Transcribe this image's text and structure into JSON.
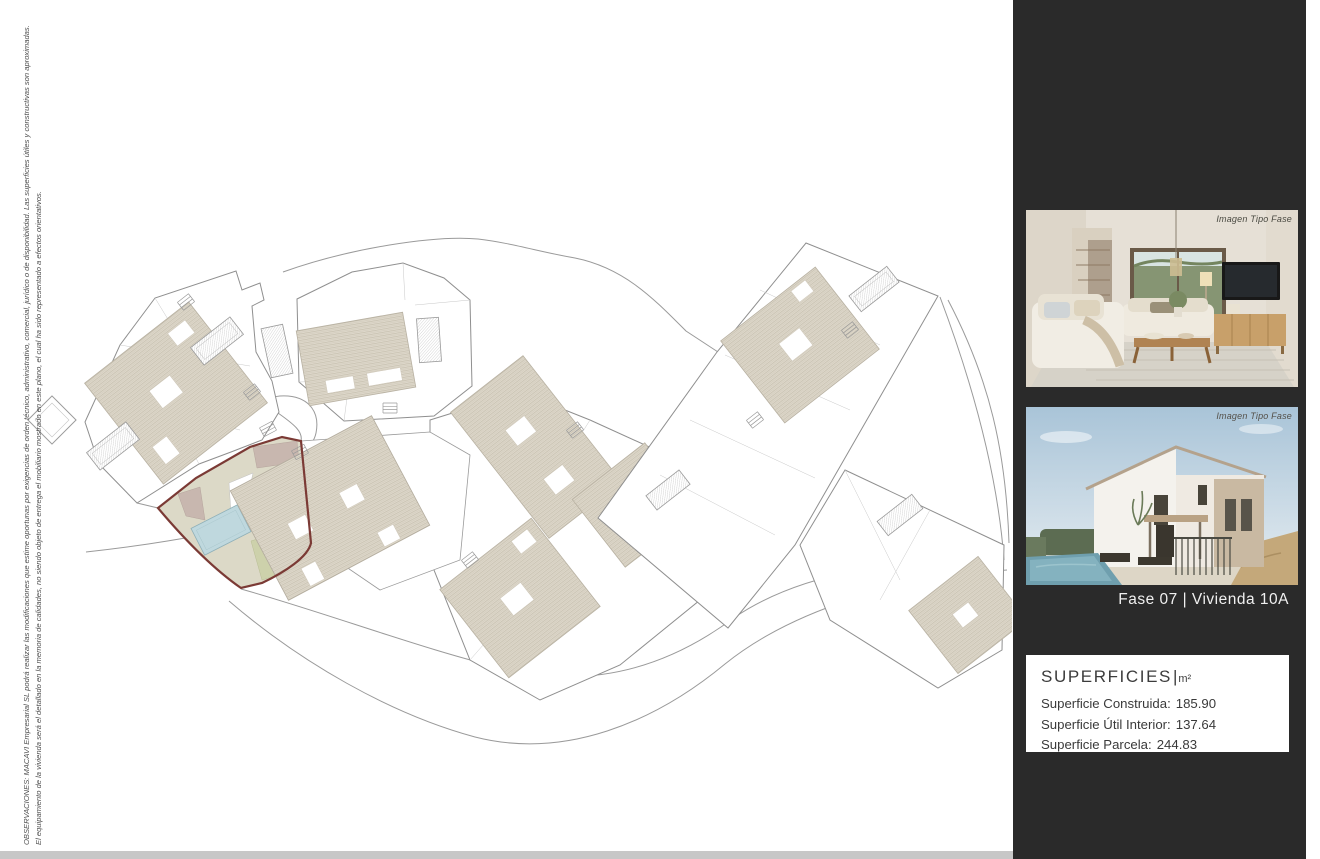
{
  "page": {
    "background": "#ffffff",
    "bottom_bar_color": "#c7c7c7"
  },
  "disclaimer": {
    "line1": "OBSERVACIONES: MACAVI Empresarial SL podrá realizar las modificaciones que estime oportunas por exigencias de orden técnico, administrativo, comercial, jurídico o de disponibilidad. Las superficies útiles y constructivas son aproximadas.",
    "line2": "El equipamiento de la vivienda será el detallado en la memoria de calidades, no siendo objeto de entrega el mobiliario mostrado en este plano, el cual ha sido representado a efectos orientativos."
  },
  "plan": {
    "colors": {
      "line": "#9a9a9a",
      "highlight_outline": "#7b3a35",
      "plot_fill": "#dcd9c7",
      "pool": "#bfd8de",
      "terrace": "#c8b7af",
      "garden": "#cdd1ab",
      "roof_hatch_base": "#ded8cb",
      "roof_hatch_line": "#c6bfae"
    }
  },
  "sidebar": {
    "background": "#2a2a2a",
    "photos": [
      {
        "label": "Imagen Tipo Fase"
      },
      {
        "label": "Imagen Tipo Fase"
      }
    ],
    "caption": "Fase 07 |  Vivienda 10A",
    "superficies": {
      "title": "SUPERFICIES",
      "separator": "|",
      "unit": "m²",
      "rows": [
        {
          "label": "Superficie Construida:",
          "value": "185.90"
        },
        {
          "label": "Superficie Útil Interior:",
          "value": "137.64"
        },
        {
          "label": "Superficie Parcela:",
          "value": "244.83"
        }
      ]
    }
  }
}
